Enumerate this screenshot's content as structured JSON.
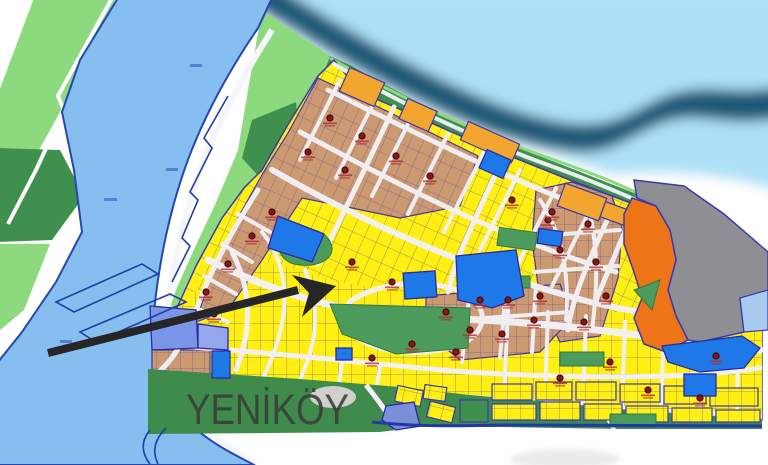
{
  "map": {
    "place_label": "YENİKÖY"
  },
  "palette": {
    "river_water": "#85BEEF",
    "sea_water": "#ADE0F6",
    "sea_band": "#1B5876",
    "bank_green": "#8CD97E",
    "forest_green": "#3F8F4F",
    "strip_green": "#3E8B4B",
    "park_green": "#4C9B5C",
    "lot_yellow": "#FFEF12",
    "lot_tan": "#CC9A70",
    "lot_orange": "#F2A52F",
    "zone_orange": "#EE7418",
    "zone_gray": "#8F8F93",
    "lot_blue": "#1F78E8",
    "lot_periwinkle": "#7B96E8",
    "outline_blue": "#3A3AB0",
    "road_white": "#F2F2F8",
    "water_line_blue": "#1D3FA8",
    "marker_red": "#8C1414",
    "arrow_black": "#262626",
    "label_gray": "#3B3B3B"
  }
}
